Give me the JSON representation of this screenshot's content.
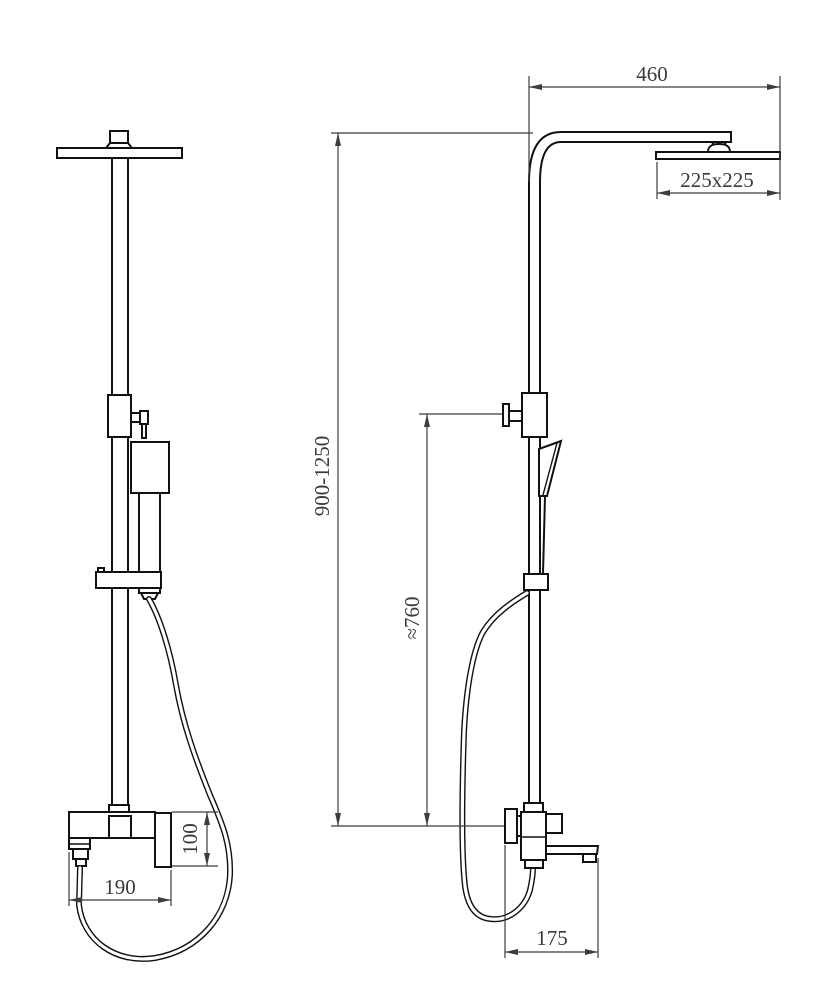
{
  "dims": {
    "arm_reach": "460",
    "head_size": "225x225",
    "height_range": "900-1250",
    "hose_outlet_height": "≈760",
    "valve_body_height": "100",
    "valve_width": "190",
    "spout_length": "175"
  }
}
